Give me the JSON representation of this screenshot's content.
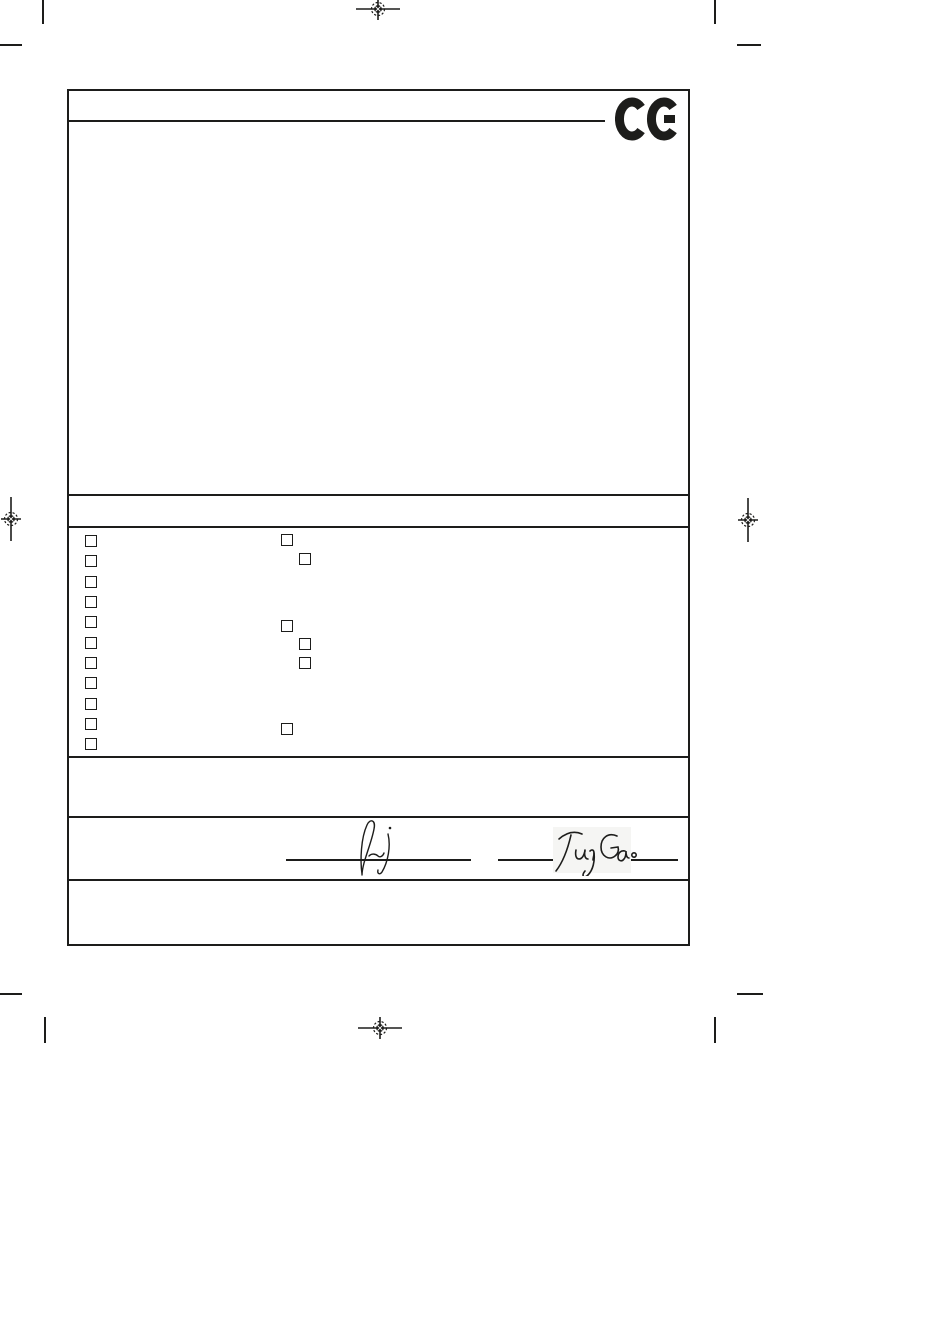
{
  "page": {
    "paper_color": "#ffffff",
    "ink_color": "#1d1d1b"
  },
  "ce_mark": {
    "label": "CE"
  },
  "form": {
    "checkboxes_left": [
      {
        "x": 16,
        "y": 444,
        "checked": false
      },
      {
        "x": 16,
        "y": 464,
        "checked": false
      },
      {
        "x": 16,
        "y": 485,
        "checked": false
      },
      {
        "x": 16,
        "y": 505,
        "checked": false
      },
      {
        "x": 16,
        "y": 525,
        "checked": false
      },
      {
        "x": 16,
        "y": 546,
        "checked": false
      },
      {
        "x": 16,
        "y": 566,
        "checked": false
      },
      {
        "x": 16,
        "y": 586,
        "checked": false
      },
      {
        "x": 16,
        "y": 607,
        "checked": false
      },
      {
        "x": 16,
        "y": 627,
        "checked": false
      },
      {
        "x": 16,
        "y": 647,
        "checked": false
      }
    ],
    "checkboxes_right": [
      {
        "x": 212,
        "y": 443,
        "checked": false
      },
      {
        "x": 230,
        "y": 462,
        "checked": false
      },
      {
        "x": 212,
        "y": 529,
        "checked": false
      },
      {
        "x": 230,
        "y": 547,
        "checked": false
      },
      {
        "x": 230,
        "y": 566,
        "checked": false
      },
      {
        "x": 212,
        "y": 632,
        "checked": false
      }
    ],
    "signatures": {
      "left": {
        "transcript": ""
      },
      "right": {
        "transcript": "TungGao"
      }
    }
  }
}
